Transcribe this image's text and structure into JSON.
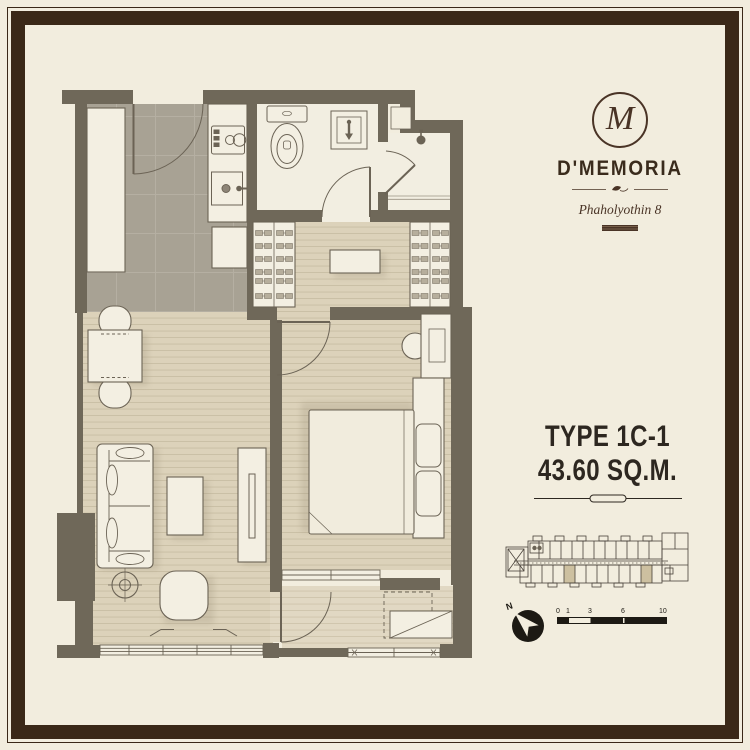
{
  "branding": {
    "monogram": "M",
    "name": "D'MEMORIA",
    "subtitle": "Phaholyothin 8"
  },
  "unit_info": {
    "type": "TYPE 1C-1",
    "area": "43.60 SQ.M."
  },
  "compass": {
    "north_label": "N"
  },
  "scale_bar": {
    "labels": [
      "0",
      "1",
      "3",
      "6",
      "10"
    ]
  },
  "colors": {
    "background": "#f2edde",
    "frame": "#3a2817",
    "wall": "#6f6859",
    "tile_floor": "#a8a294",
    "wood_floor": "#dcd2ba",
    "balcony_floor": "#e1d8c3",
    "fixture_fill": "#f3efe2",
    "line": "#6b6355",
    "brand_brown": "#4a3426",
    "text": "#2d2720",
    "keyplan_highlight": "#cdc0a0"
  }
}
